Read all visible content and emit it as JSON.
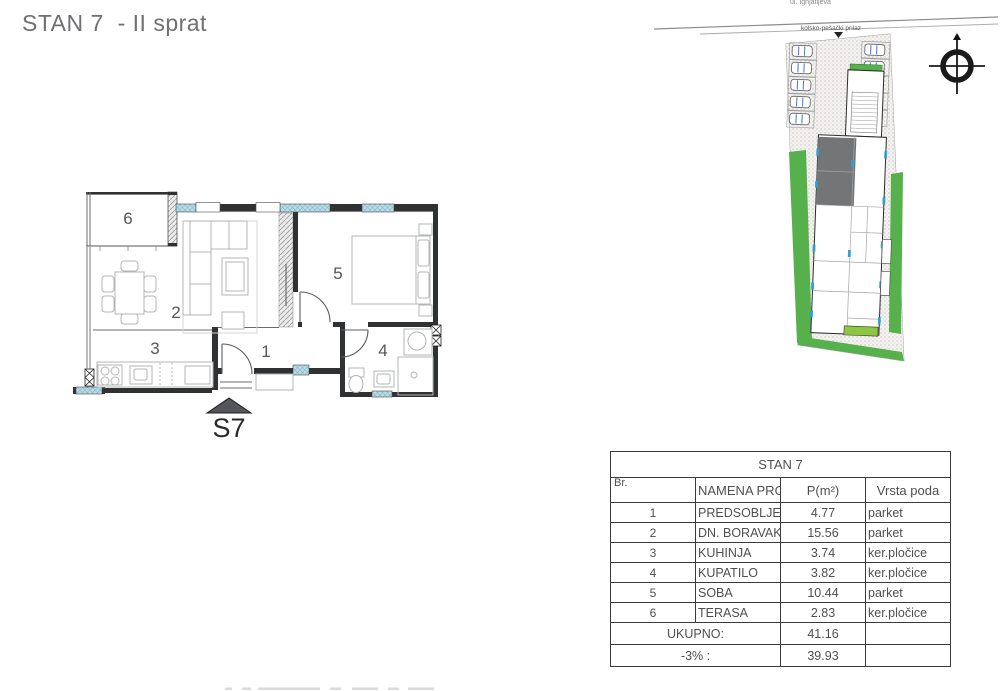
{
  "page": {
    "title": "STAN 7  - II sprat"
  },
  "floor_plan": {
    "room_labels": {
      "r1": "1",
      "r2": "2",
      "r3": "3",
      "r4": "4",
      "r5": "5",
      "r6": "6"
    },
    "marker_label": "S7"
  },
  "site_plan": {
    "street_name": "ul. Ignjatijeva",
    "access_label": "kolsko-pešački prilaz"
  },
  "table": {
    "title": "STAN 7",
    "headers": {
      "br": "Br.",
      "name": "NAMENA PROSTORIJA",
      "area": "P(m²)",
      "floor": "Vrsta poda"
    },
    "rows": [
      {
        "br": "1",
        "name": "PREDSOBLJE",
        "area": "4.77",
        "floor": "parket"
      },
      {
        "br": "2",
        "name": "DN. BORAVAK S TRPEZARIJOM",
        "area": "15.56",
        "floor": "parket"
      },
      {
        "br": "3",
        "name": "KUHINJA",
        "area": "3.74",
        "floor": "ker.pločice"
      },
      {
        "br": "4",
        "name": "KUPATILO",
        "area": "3.82",
        "floor": "ker.pločice"
      },
      {
        "br": "5",
        "name": "SOBA",
        "area": "10.44",
        "floor": "parket"
      },
      {
        "br": "6",
        "name": "TERASA",
        "area": "2.83",
        "floor": "ker.pločice"
      }
    ],
    "total": {
      "label": "UKUPNO:",
      "value": "41.16"
    },
    "discount": {
      "label": "-3% :",
      "value": "39.93"
    }
  },
  "colors": {
    "accent_green": "#56b04c",
    "window_blue": "#b5dde9",
    "wall_black": "#2f3133",
    "highlight_gray": "#737577"
  }
}
